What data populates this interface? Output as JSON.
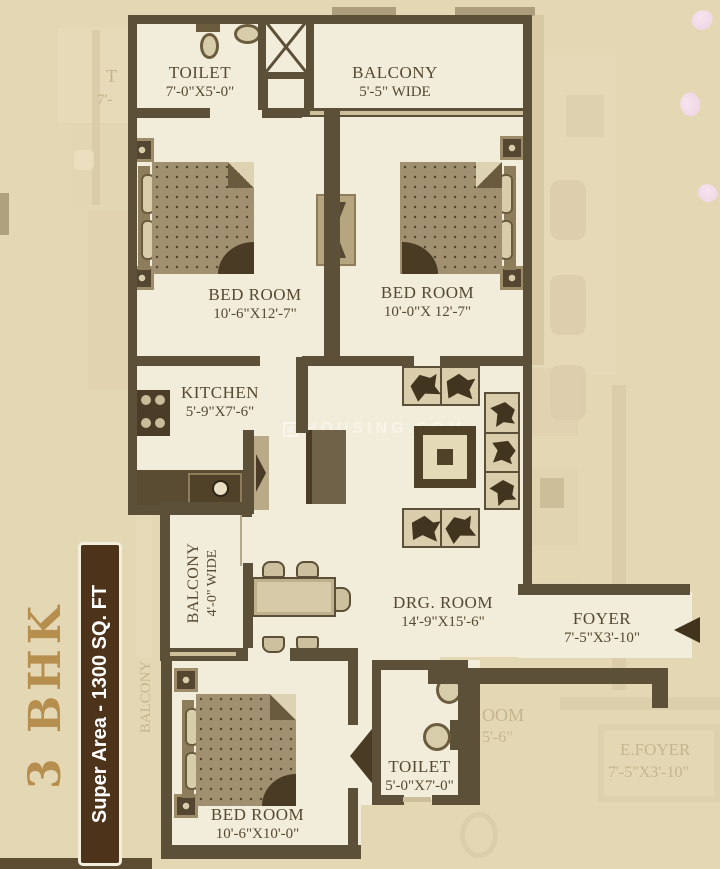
{
  "badge": {
    "bhk_label": "3 BHK",
    "super_area_label": "Super Area - 1300 SQ. FT"
  },
  "watermark": {
    "text": "HOUSING.COM"
  },
  "rooms": [
    {
      "name": "TOILET",
      "dims": "7'-0\"X5'-0\""
    },
    {
      "name": "BALCONY",
      "dims": "5'-5\" WIDE"
    },
    {
      "name": "BED ROOM",
      "dims": "10'-6\"X12'-7\""
    },
    {
      "name": "BED ROOM",
      "dims": "10'-0\"X 12'-7\""
    },
    {
      "name": "KITCHEN",
      "dims": "5'-9\"X7'-6\""
    },
    {
      "name": "BALCONY",
      "dims": "4'-0\" WIDE"
    },
    {
      "name": "DRG. ROOM",
      "dims": "14'-9\"X15'-6\""
    },
    {
      "name": "FOYER",
      "dims": "7'-5\"X3'-10\""
    },
    {
      "name": "TOILET",
      "dims": "5'-0\"X7'-0\""
    },
    {
      "name": "BED ROOM",
      "dims": "10'-6\"X10'-0\""
    }
  ],
  "adjacent_unit_texts": {
    "toilet_fragment_line1": "T",
    "toilet_fragment_line2": "7'-",
    "balcony_vertical": "BALCONY",
    "room_fragment_line1": "OOM",
    "room_fragment_line2": "5'-6\"",
    "efoyer_line1": "E.FOYER",
    "efoyer_line2": "7'-5\"X3'-10\""
  },
  "colors": {
    "bg": "#e4d7b4",
    "cream": "#f2ecda",
    "wall": "#5c5038",
    "wall-light": "#cdbf9a",
    "furn-dark": "#4a3c26",
    "furn-mid": "#8d7d5a",
    "furn-light": "#d8cdaa",
    "mattress": "#a09070",
    "label": "#564931",
    "faint": "#c0b087",
    "gold": "#b68e4d",
    "badge-bg": "#4c3319",
    "petal": "#eed3e2"
  }
}
